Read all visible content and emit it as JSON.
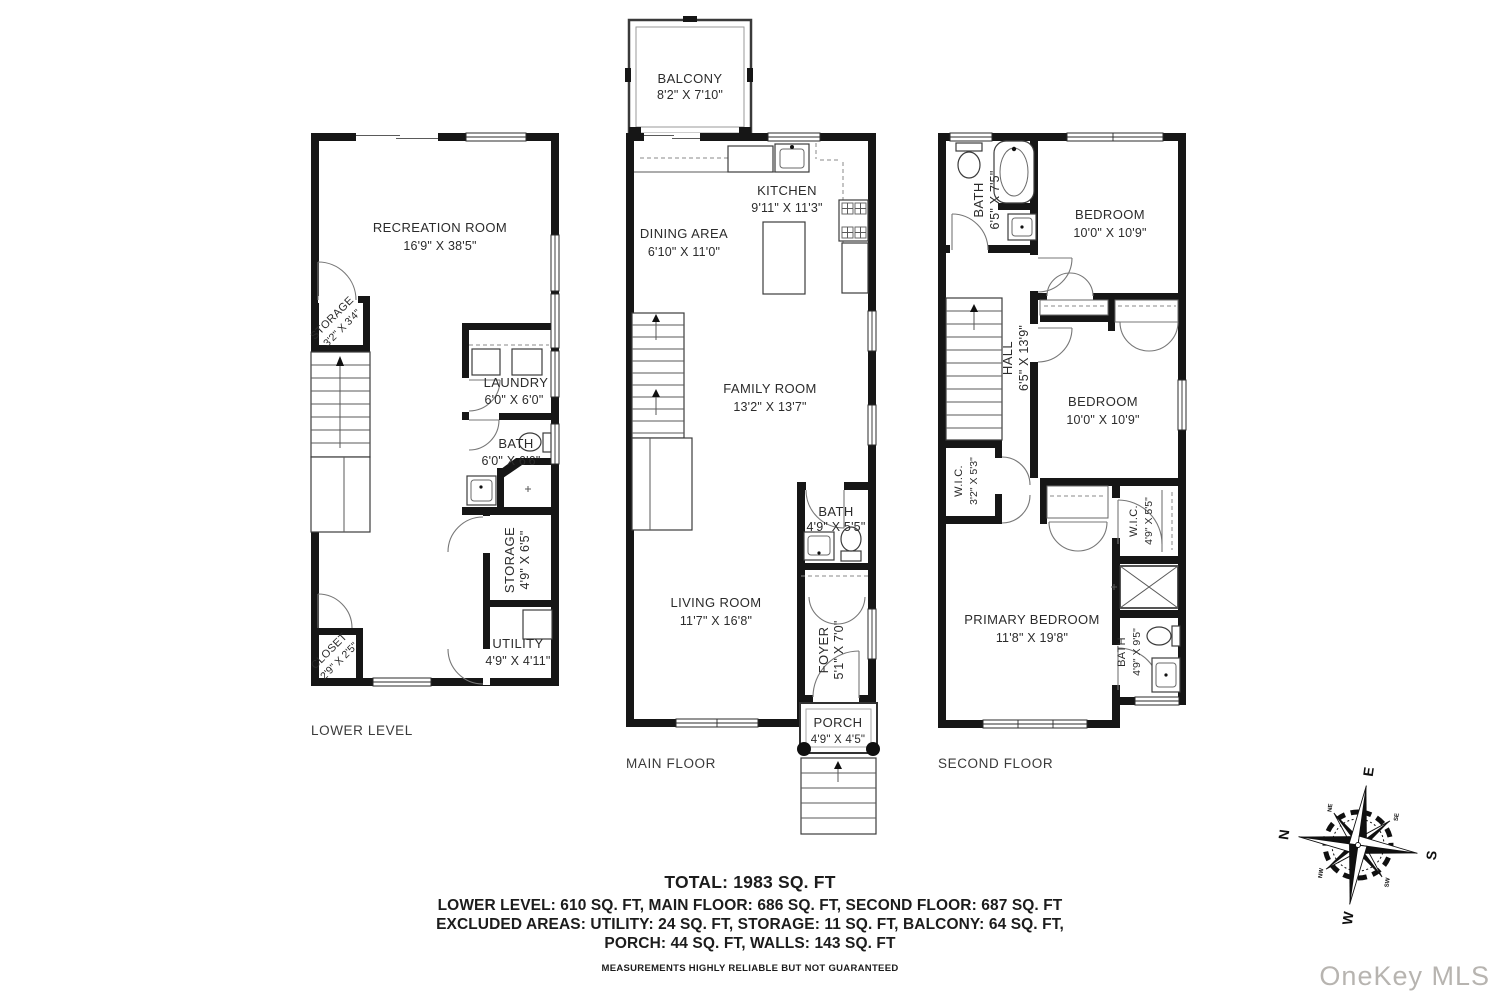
{
  "floors": {
    "lower": {
      "label": "LOWER LEVEL",
      "rooms": {
        "recreation": {
          "name": "RECREATION ROOM",
          "dims": "16'9\" X 38'5\""
        },
        "storage_upper": {
          "name": "STORAGE",
          "dims": "3'2\" X 3'4\""
        },
        "laundry": {
          "name": "LAUNDRY",
          "dims": "6'0\" X 6'0\""
        },
        "bath": {
          "name": "BATH",
          "dims": "6'0\" X 6'6\""
        },
        "storage": {
          "name": "STORAGE",
          "dims": "4'9\" X 6'5\""
        },
        "utility": {
          "name": "UTILITY",
          "dims": "4'9\" X 4'11\""
        },
        "closet": {
          "name": "CLOSET",
          "dims": "2'9\" X 2'5\""
        }
      }
    },
    "main": {
      "label": "MAIN FLOOR",
      "rooms": {
        "balcony": {
          "name": "BALCONY",
          "dims": "8'2\" X 7'10\""
        },
        "kitchen": {
          "name": "KITCHEN",
          "dims": "9'11\" X 11'3\""
        },
        "dining": {
          "name": "DINING AREA",
          "dims": "6'10\" X 11'0\""
        },
        "family": {
          "name": "FAMILY ROOM",
          "dims": "13'2\" X 13'7\""
        },
        "bath": {
          "name": "BATH",
          "dims": "4'9\" X 5'5\""
        },
        "living": {
          "name": "LIVING ROOM",
          "dims": "11'7\" X 16'8\""
        },
        "foyer": {
          "name": "FOYER",
          "dims": "5'1\" X 7'0\""
        },
        "porch": {
          "name": "PORCH",
          "dims": "4'9\" X 4'5\""
        }
      }
    },
    "second": {
      "label": "SECOND FLOOR",
      "rooms": {
        "bath": {
          "name": "BATH",
          "dims": "6'5\" X 7'5\""
        },
        "bedroom1": {
          "name": "BEDROOM",
          "dims": "10'0\" X 10'9\""
        },
        "hall": {
          "name": "HALL",
          "dims": "6'5\" X 13'9\""
        },
        "bedroom2": {
          "name": "BEDROOM",
          "dims": "10'0\" X 10'9\""
        },
        "wic1": {
          "name": "W.I.C.",
          "dims": "3'2\" X 5'3\""
        },
        "wic2": {
          "name": "W.I.C.",
          "dims": "4'9\" X 5'5\""
        },
        "primary": {
          "name": "PRIMARY BEDROOM",
          "dims": "11'8\" X 19'8\""
        },
        "bath2": {
          "name": "BATH",
          "dims": "4'9\" X 9'5\""
        }
      }
    }
  },
  "summary": {
    "total": "TOTAL: 1983 SQ. FT",
    "line1": "LOWER LEVEL: 610 SQ. FT, MAIN FLOOR: 686 SQ. FT, SECOND FLOOR: 687 SQ. FT",
    "line2": "EXCLUDED AREAS: UTILITY: 24 SQ. FT, STORAGE: 11 SQ. FT, BALCONY: 64 SQ. FT,",
    "line3": "PORCH: 44 SQ. FT, WALLS: 143 SQ. FT",
    "disclaimer": "MEASUREMENTS HIGHLY RELIABLE BUT NOT GUARANTEED"
  },
  "compass": {
    "north": "N",
    "east": "E",
    "south": "S",
    "west": "W",
    "northeast": "NE",
    "southeast": "SE",
    "southwest": "SW",
    "northwest": "NW"
  },
  "watermark": "OneKey MLS",
  "colors": {
    "wall": "#161616",
    "text": "#2b2b2b",
    "watermark": "#b7b4b0"
  }
}
